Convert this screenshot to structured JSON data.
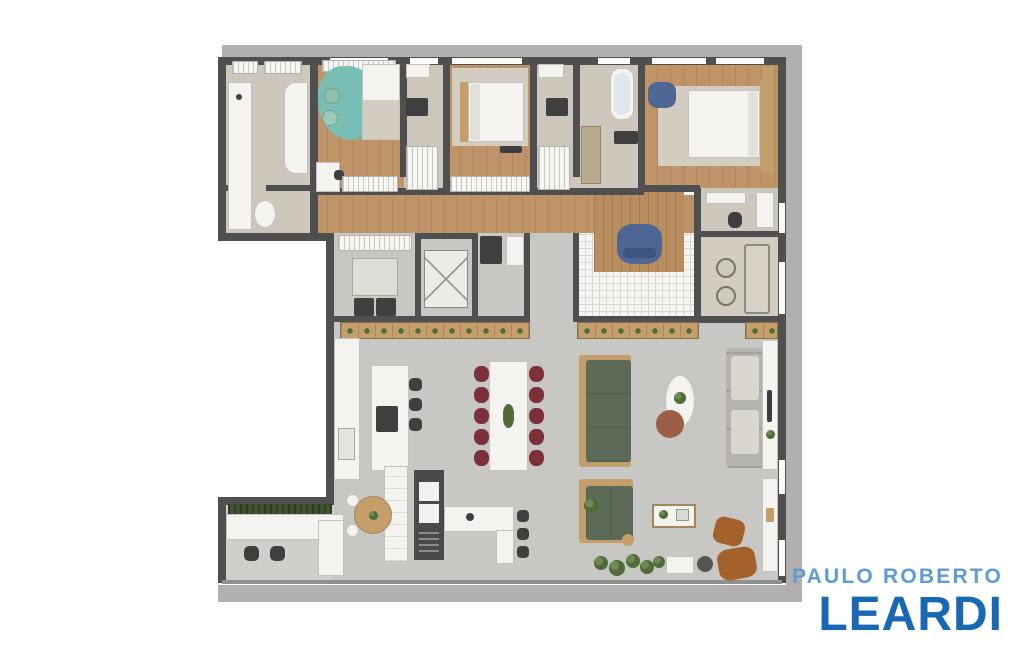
{
  "logo": {
    "line1": "PAULO ROBERTO",
    "line2": "LEARDI"
  },
  "colors": {
    "wall": "#4f4f4f",
    "band": "#b1b0ae",
    "wood": "#bf9468",
    "deck": "#b98e5f",
    "rug_beige": "#d2ccc1",
    "bath_floor": "#cdc6ba",
    "gray_floor": "#c7c7c3",
    "terrace_floor": "#cfcfcb",
    "white_surface": "#f4f3f0",
    "teal_rug": "#7abfb6",
    "blue_chair": "#4d6694",
    "green_sofa": "#5c6a58",
    "red_chair": "#7d303a",
    "wood_furniture": "#c49e6b",
    "plant_green": "#4e6b3c",
    "hedge_green": "#3e5330",
    "brown_chair": "#a5612c",
    "appliance_dark": "#3f3f3f",
    "gray_sofa": "#b5b3ae",
    "pouf": "#9c5f45",
    "logo_light": "#5d9cd3",
    "logo_dark": "#1868b3"
  }
}
